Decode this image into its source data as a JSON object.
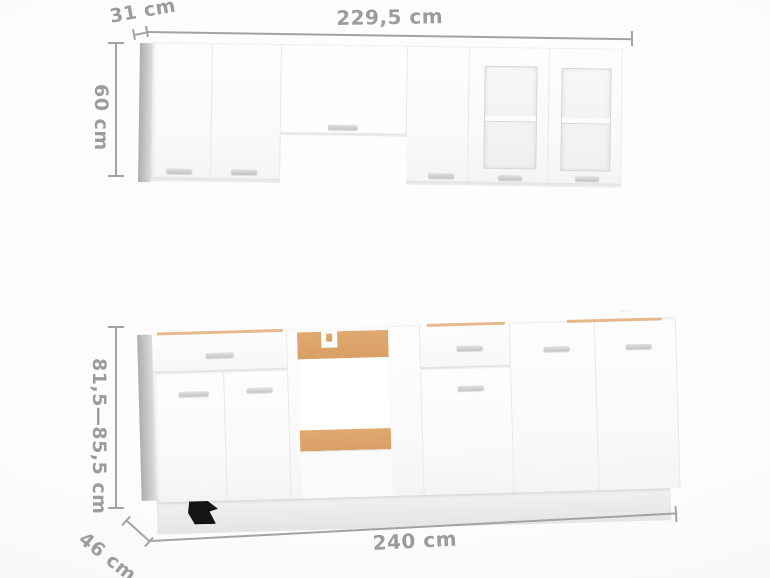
{
  "dimension_labels": {
    "wall_depth": "31 cm",
    "wall_width": "229,5 cm",
    "wall_height": "60 cm",
    "base_height": "81,5—85,5 cm",
    "base_depth": "46 cm",
    "base_width": "240 cm"
  },
  "colors": {
    "dimension_gray": "#a3a3a3",
    "label_gray": "#9c9c9c",
    "chipboard_tan": "#dfa96f",
    "cabinet_white": "#fbfbfb",
    "side_panel_gray": "#bcbcbc",
    "handle_gray": "#c4c4c4",
    "plinth_gray": "#ebebeb",
    "foot_black": "#141414",
    "background": "#f7f7f7"
  }
}
